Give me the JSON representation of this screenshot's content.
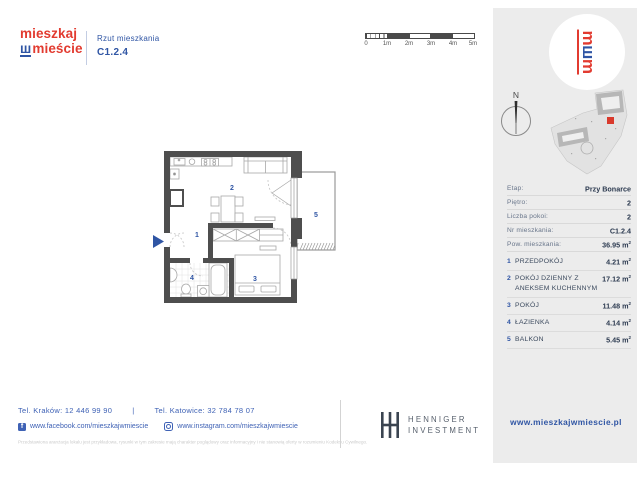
{
  "brand": {
    "logo_word1": "mieszkaj",
    "logo_w": "ш",
    "logo_word2": "mieście",
    "badge": {
      "m1": "m",
      "w": "ш",
      "m2": "m"
    }
  },
  "header": {
    "doc_type": "Rzut mieszkania",
    "unit_code": "C1.2.4"
  },
  "scalebar": {
    "labels": [
      "0",
      "1m",
      "2m",
      "3m",
      "4m",
      "5m"
    ]
  },
  "compass": {
    "north_label": "N"
  },
  "info_table": {
    "rows": [
      {
        "label": "Etap:",
        "value": "Przy Bonarce",
        "sup": ""
      },
      {
        "label": "Piętro:",
        "value": "2",
        "sup": ""
      },
      {
        "label": "Liczba pokoi:",
        "value": "2",
        "sup": ""
      },
      {
        "label": "Nr mieszkania:",
        "value": "C1.2.4",
        "sup": ""
      },
      {
        "label": "Pow. mieszkania:",
        "value": "36.95 m",
        "sup": "2"
      }
    ]
  },
  "rooms": [
    {
      "num": "1",
      "name": "PRZEDPOKÓJ",
      "area": "4.21 m",
      "sup": "2"
    },
    {
      "num": "2",
      "name": "POKÓJ DZIENNY Z ANEKSEM KUCHENNYM",
      "area": "17.12 m",
      "sup": "2"
    },
    {
      "num": "3",
      "name": "POKÓJ",
      "area": "11.48 m",
      "sup": "2"
    },
    {
      "num": "4",
      "name": "ŁAZIENKA",
      "area": "4.14 m",
      "sup": "2"
    },
    {
      "num": "5",
      "name": "BALKON",
      "area": "5.45 m",
      "sup": "2"
    }
  ],
  "footer": {
    "tel_krakow": "Tel. Kraków: 12 446 99 90",
    "separator": "|",
    "tel_katowice": "Tel. Katowice: 32 784 78 07",
    "facebook_glyph": "f",
    "facebook_url": "www.facebook.com/mieszkajwmiescie",
    "instagram_url": "www.instagram.com/mieszkajwmiescie",
    "disclaimer": "Przedstawiona aranżacja lokalu jest przykładowa, rysunki w tym zakresie mają charakter poglądowy oraz informacyjny i nie stanowią oferty w rozumieniu Kodeksu Cywilnego.",
    "website": "www.mieszkajwmiescie.pl"
  },
  "developer": {
    "line1": "HENNIGER",
    "line2": "INVESTMENT"
  },
  "colors": {
    "brand_red": "#e23b30",
    "brand_blue": "#2f55a4",
    "wall_gray": "#4e4e4e",
    "sidebar_bg": "#ececec"
  }
}
